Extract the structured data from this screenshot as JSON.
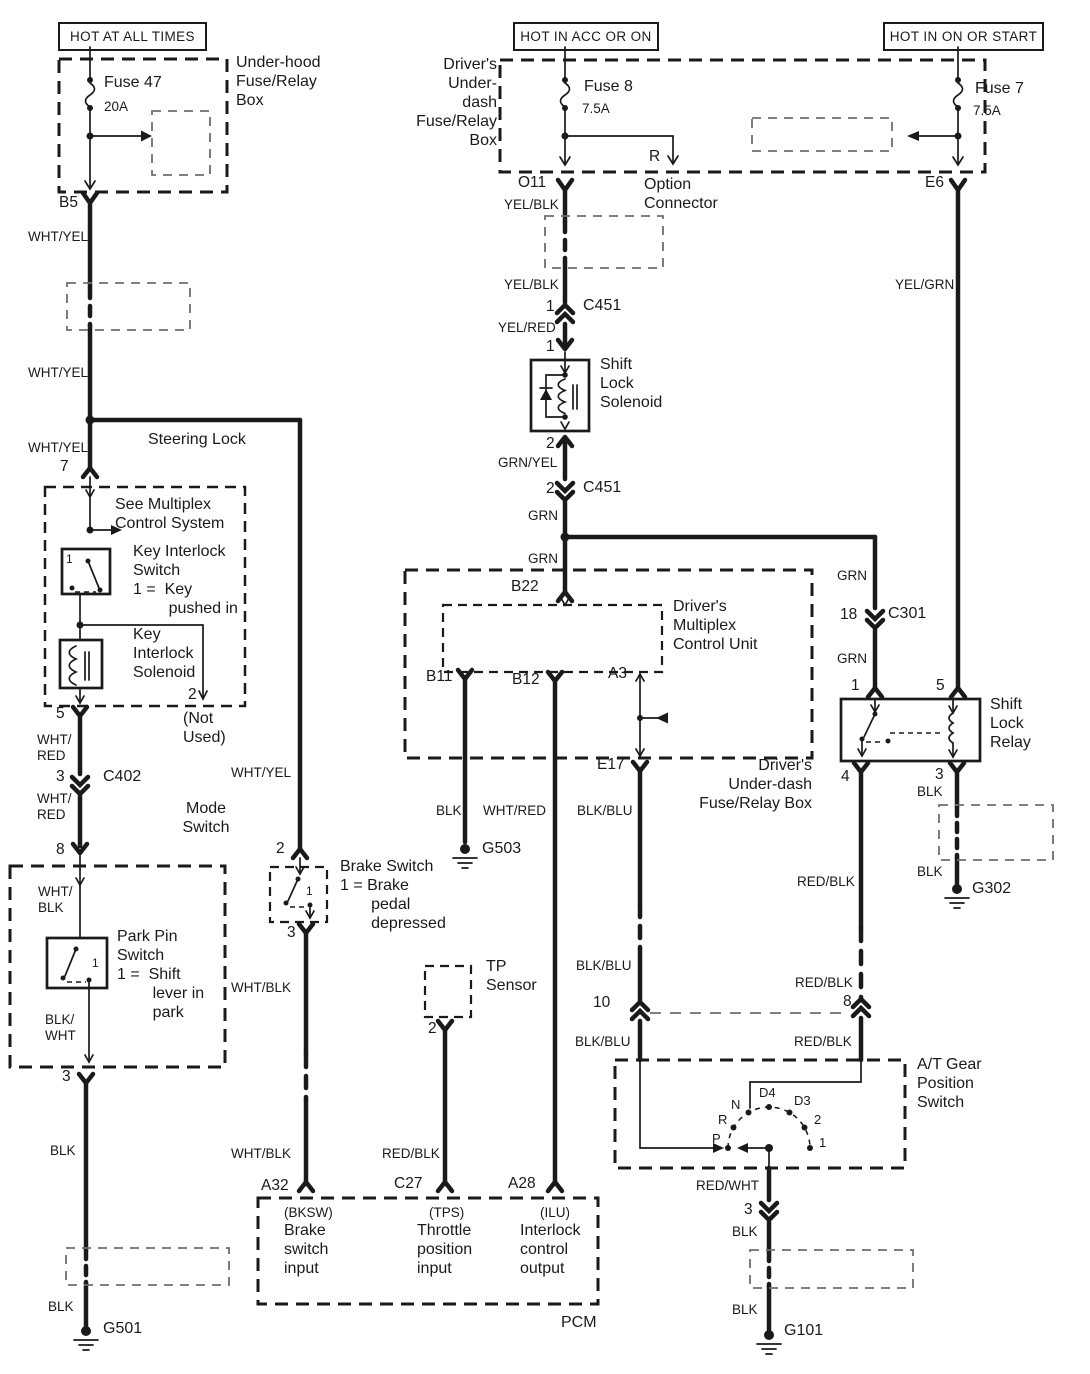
{
  "headers": {
    "left": "HOT AT ALL TIMES",
    "middle": "HOT IN ACC OR ON",
    "right": "HOT IN ON OR START"
  },
  "labels": {
    "underhood": "Under-hood\nFuse/Relay\nBox",
    "fuse47": "Fuse 47",
    "fuse47_rating": "20A",
    "fuse8": "Fuse 8",
    "fuse8_rating": "7.5A",
    "fuse7": "Fuse 7",
    "fuse7_rating": "7.5A",
    "underdash_top": "Driver's\nUnder-dash\nFuse/Relay\nBox",
    "option_connector": "Option\nConnector",
    "steering_lock": "Steering Lock",
    "see_multiplex": "See Multiplex\nControl System",
    "key_interlock_switch": "Key Interlock\nSwitch\n1 =  Key\n        pushed in",
    "key_interlock_solenoid": "Key\nInterlock\nSolenoid",
    "not_used": "(Not\nUsed)",
    "mode_switch": "Mode\nSwitch",
    "park_pin_switch": "Park Pin\nSwitch\n1 =  Shift\n        lever in\n        park",
    "brake_switch": "Brake Switch\n1 = Brake\n       pedal\n       depressed",
    "tp_sensor": "TP\nSensor",
    "shift_lock_solenoid": "Shift\nLock\nSolenoid",
    "multiplex_unit": "Driver's\nMultiplex\nControl Unit",
    "underdash_mid": "Driver's\nUnder-dash\nFuse/Relay Box",
    "shift_lock_relay": "Shift\nLock\nRelay",
    "at_gear_switch": "A/T Gear\nPosition\nSwitch",
    "pcm": "PCM",
    "bksw": "(BKSW)",
    "bksw_desc": "Brake\nswitch\ninput",
    "tps": "(TPS)",
    "tps_desc": "Throttle\nposition\ninput",
    "ilu": "(ILU)",
    "ilu_desc": "Interlock\ncontrol\noutput"
  },
  "pins": {
    "b5": "B5",
    "o11": "O11",
    "e6": "E6",
    "r": "R",
    "one": "1",
    "two": "2",
    "three": "3",
    "four": "4",
    "five": "5",
    "seven": "7",
    "eight": "8",
    "ten": "10",
    "eighteen": "18",
    "b22": "B22",
    "b11": "B11",
    "b12": "B12",
    "a3": "A3",
    "e17": "E17",
    "a32": "A32",
    "c27": "C27",
    "a28": "A28",
    "c402": "C402",
    "c451": "C451",
    "c301": "C301"
  },
  "wires": {
    "wht_yel": "WHT/YEL",
    "wht_red_2line": "WHT/\nRED",
    "wht_blk_2line": "WHT/\nBLK",
    "blk_wht_2line": "BLK/\nWHT",
    "wht_blk": "WHT/BLK",
    "blk": "BLK",
    "yel_blk": "YEL/BLK",
    "yel_red": "YEL/RED",
    "grn_yel": "GRN/YEL",
    "grn": "GRN",
    "yel_grn": "YEL/GRN",
    "wht_red": "WHT/RED",
    "blk_blu": "BLK/BLU",
    "red_blk": "RED/BLK",
    "red_wht": "RED/WHT"
  },
  "grounds": {
    "g501": "G501",
    "g503": "G503",
    "g302": "G302",
    "g101": "G101"
  },
  "gear_positions": {
    "p": "P",
    "r": "R",
    "n": "N",
    "d4": "D4",
    "d3": "D3",
    "two": "2",
    "one": "1"
  },
  "colors": {
    "line": "#1a1a1a",
    "background": "#ffffff"
  }
}
